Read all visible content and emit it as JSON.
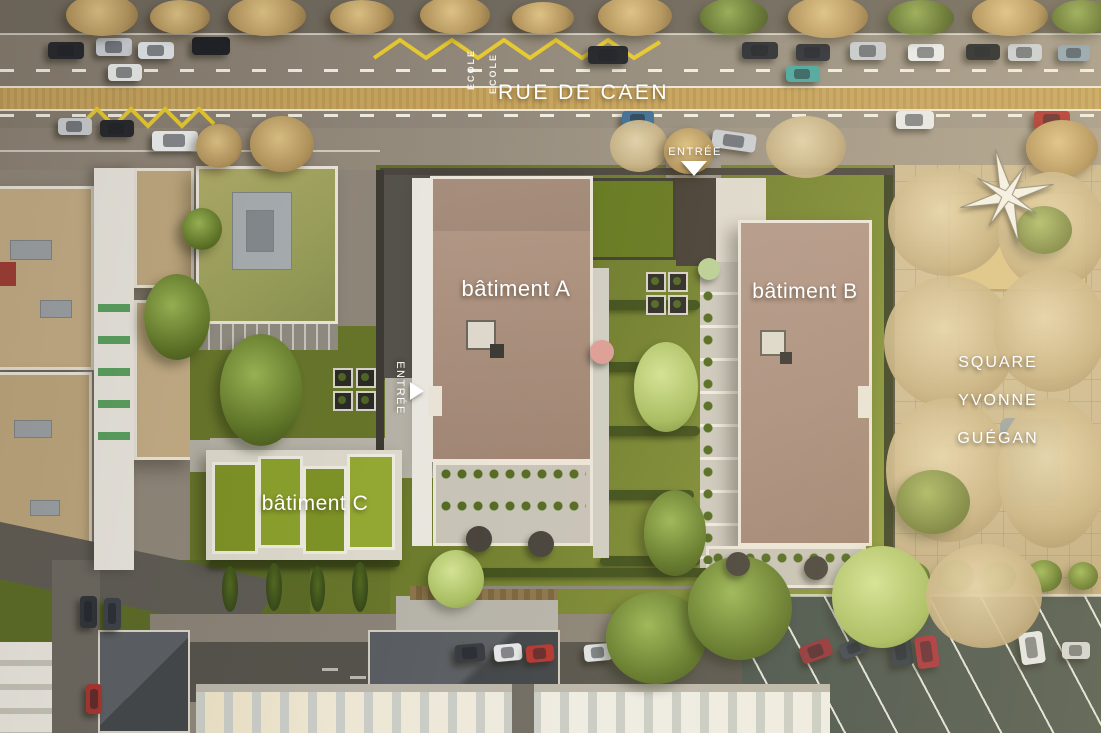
{
  "street": {
    "name": "RUE DE CAEN",
    "school_marking": "ECOLE"
  },
  "site": {
    "building_a_label": "bâtiment A",
    "building_b_label": "bâtiment B",
    "building_c_label": "bâtiment C",
    "entrance_top_label": "ENTRÉE",
    "entrance_west_label": "ENTRÉE"
  },
  "park": {
    "name_line1": "SQUARE",
    "name_line2": "YVONNE",
    "name_line3": "GUÉGAN"
  },
  "icons": {
    "compass": "compass-rose-icon",
    "entrance_arrow_top": "triangle-down-arrow",
    "entrance_arrow_west": "triangle-right-arrow"
  },
  "colors": {
    "roof_building_a": "#a78c7b",
    "roof_building_b": "#a98e7e",
    "green_roof_building_c": "#7d9226",
    "site_grass": "#6f7d2d",
    "road_asphalt": "#8f867a",
    "median_strip": "#c5a35e",
    "zigzag_marking": "#e6c930",
    "park_ground": "#c9b68e",
    "label_text": "#ffffff"
  }
}
